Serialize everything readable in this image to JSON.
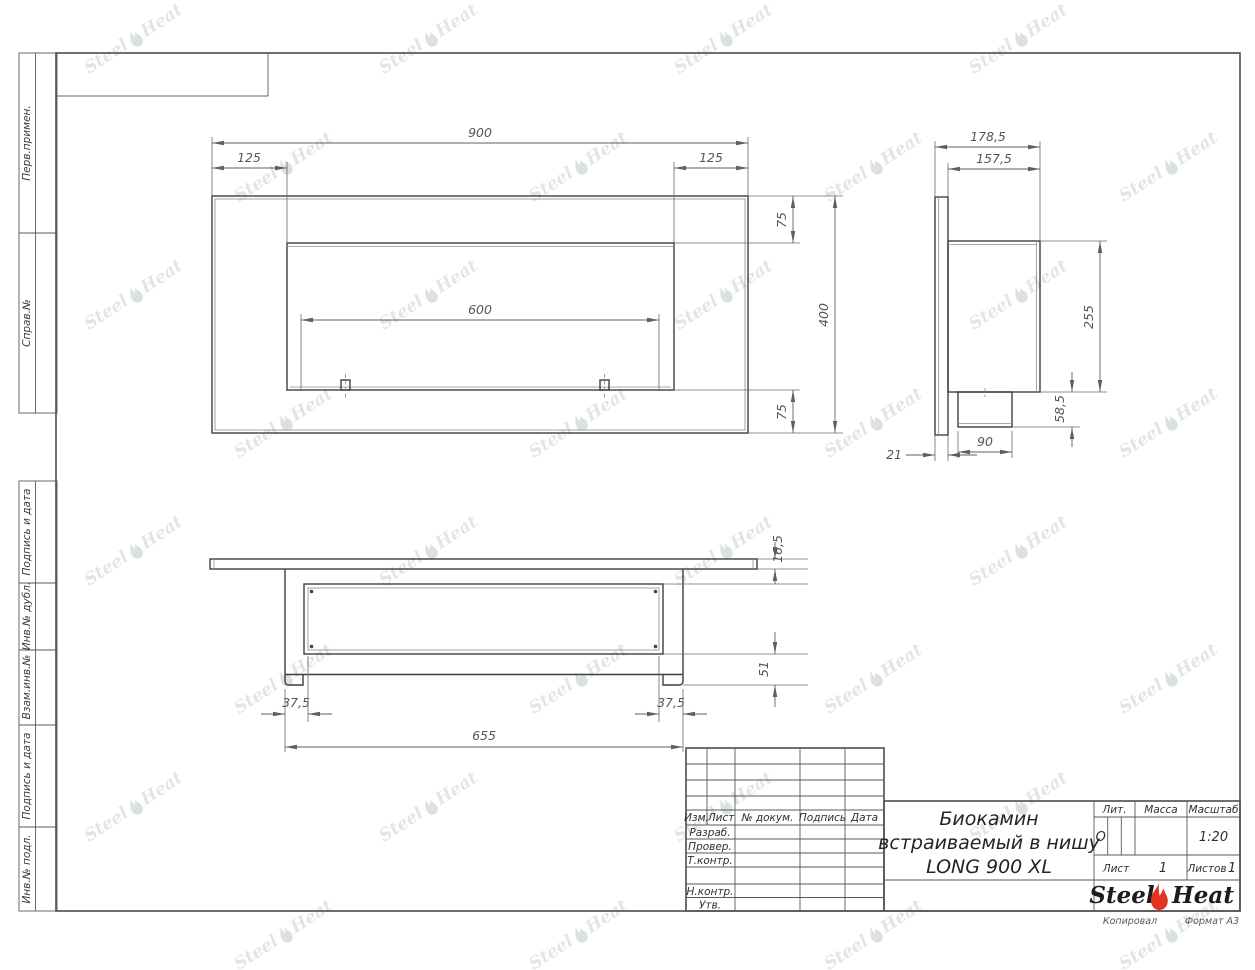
{
  "watermark": {
    "steel": "Steel",
    "heat": "Heat"
  },
  "margin_labels": [
    "Перв.примен.",
    "Справ.№",
    "Подпись и дата",
    "Инв.№ дубл.",
    "Взам.инв.№",
    "Подпись и дата",
    "Инв.№ подл."
  ],
  "views": {
    "front": {
      "dims": {
        "total_width": "900",
        "left_offset": "125",
        "right_offset": "125",
        "top_margin": "75",
        "total_height": "400",
        "burner_width": "600",
        "bottom_margin": "75"
      }
    },
    "side": {
      "dims": {
        "total_depth": "178,5",
        "body_depth": "157,5",
        "body_height": "255",
        "spout_height": "58,5",
        "spout_depth": "90",
        "flange_thickness": "21"
      }
    },
    "bottom": {
      "dims": {
        "flange_thickness": "16,5",
        "body_height": "51",
        "left_inset": "37,5",
        "right_inset": "37,5",
        "body_width": "655"
      }
    }
  },
  "title_block": {
    "header_cols": [
      "Изм.",
      "Лист",
      "№ докум.",
      "Подпись",
      "Дата"
    ],
    "row_labels": [
      "Разраб.",
      "Провер.",
      "Т.контр.",
      "Н.контр.",
      "Утв."
    ],
    "product_title": [
      "Биокамин",
      "встраиваемый в нишу",
      "LONG 900 XL"
    ],
    "lit_label": "Лит.",
    "lit_value": "О",
    "mass_label": "Масса",
    "scale_label": "Масштаб",
    "scale_value": "1:20",
    "sheet_label": "Лист",
    "sheet_value": "1",
    "sheets_label": "Листов",
    "sheets_value": "1",
    "company": {
      "steel": "Steel",
      "heat": "Heat"
    },
    "footer_left": "Копировал",
    "footer_right": "Формат А3"
  }
}
